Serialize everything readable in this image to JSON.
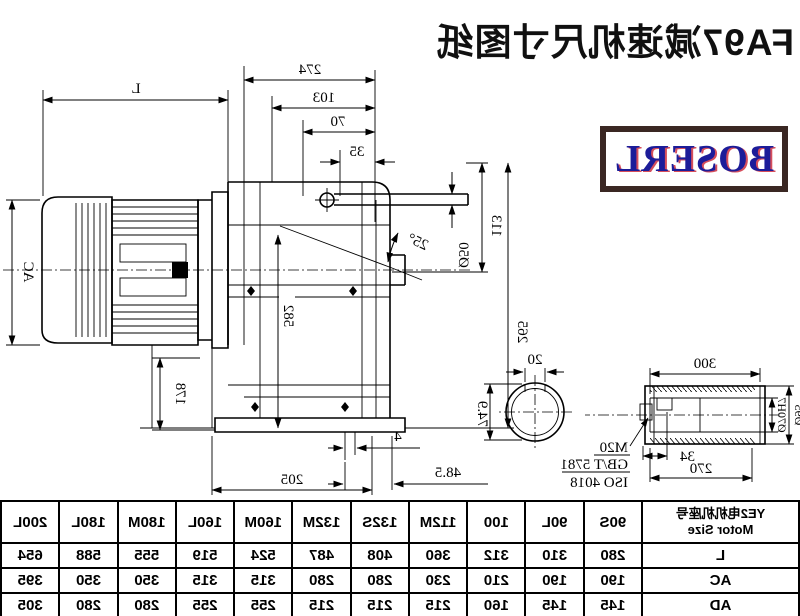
{
  "title": "FA97减速机尺寸图纸",
  "logo": "BOSERL",
  "colors": {
    "line": "#000000",
    "title_text": "#101010",
    "logo_blue": "#1c1c99",
    "logo_red": "#cc2233",
    "logo_border": "#3a2723"
  },
  "drawing": {
    "labels": {
      "l": "L",
      "ac": "AC",
      "d274": "274",
      "d103": "103",
      "d70": "70",
      "d35": "35",
      "d582": "582",
      "angle": "25°",
      "dia50": "Ø50",
      "d113": "113",
      "d265": "265",
      "d178": "178",
      "d205": "205",
      "d4": "4",
      "d48_5": "48.5",
      "d20": "20",
      "d74_9": "74.9",
      "d300": "300",
      "d270": "270",
      "d34": "34",
      "note_m20": "M20",
      "note_gbt": "GB/T 5781",
      "note_iso": "ISO 4018",
      "dia70": "Ø70H7",
      "dia95": "Ø95"
    }
  },
  "table": {
    "header_cn": "YE2电机机座号",
    "header_en": "Motor Size",
    "columns": [
      "90S",
      "90L",
      "100",
      "112M",
      "132S",
      "132M",
      "160M",
      "160L",
      "180M",
      "180L",
      "200L"
    ],
    "rows": [
      {
        "label": "L",
        "values": [
          "280",
          "310",
          "312",
          "360",
          "408",
          "487",
          "524",
          "519",
          "555",
          "588",
          "654"
        ]
      },
      {
        "label": "AC",
        "values": [
          "190",
          "190",
          "210",
          "230",
          "280",
          "280",
          "315",
          "315",
          "350",
          "350",
          "395"
        ]
      },
      {
        "label": "AD",
        "values": [
          "145",
          "145",
          "160",
          "215",
          "215",
          "215",
          "255",
          "255",
          "280",
          "280",
          "305"
        ]
      }
    ]
  }
}
